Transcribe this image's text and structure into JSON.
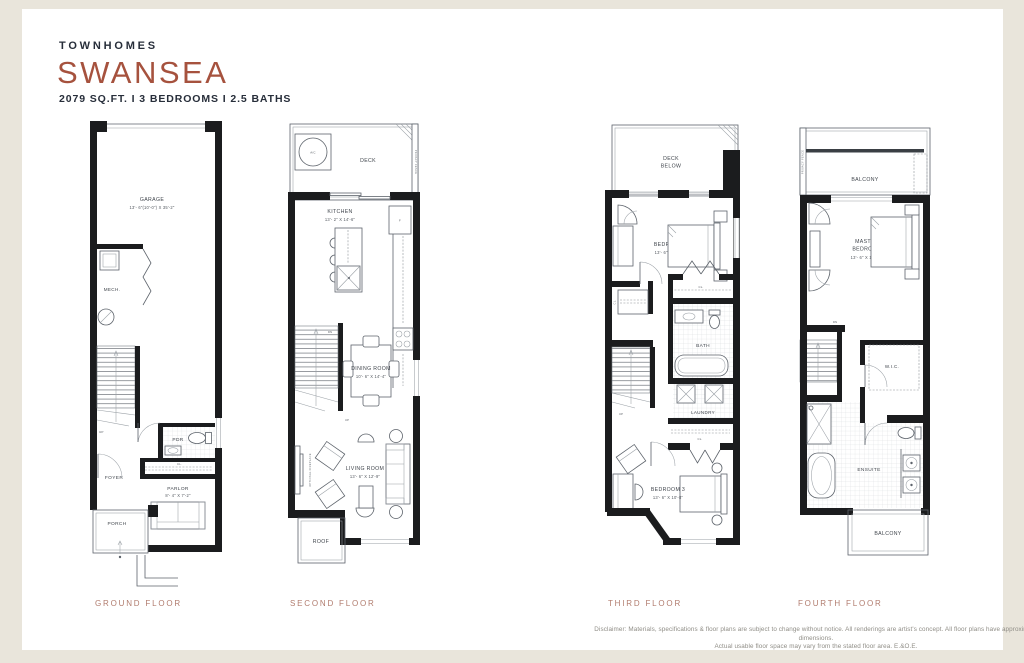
{
  "header": {
    "collection": "TOWNHOMES",
    "model": "SWANSEA",
    "specs": "2079 SQ.FT. I 3 BEDROOMS I 2.5 BATHS"
  },
  "colors": {
    "accent": "#A6523E",
    "caption": "#B17C6E",
    "frame_background": "#E9E5DB",
    "page_background": "#FFFFFF",
    "ink": "#272E3A",
    "wall": "#1B1C1E"
  },
  "plans": {
    "ground": {
      "label": "GROUND FLOOR",
      "garage": "GARAGE",
      "garage_dims": "13'- 6\"(10'-0\") X 35'-2\"",
      "mech": "MECH.",
      "up": "UP",
      "pdr": "PDR",
      "cl": "CL.",
      "foyer": "FOYER",
      "parlor": "PARLOR",
      "parlor_dims": "8'- 4\" X 7'-2\"",
      "porch": "PORCH"
    },
    "second": {
      "label": "SECOND FLOOR",
      "deck": "DECK",
      "ac": "A/C",
      "privacy_fence": "PRIVACY FENCE",
      "kitchen": "KITCHEN",
      "kitchen_dims": "13'- 2\" X 14'-6\"",
      "fridge": "F",
      "dn": "DN",
      "up": "UP",
      "dining": "DINING ROOM",
      "dining_dims": "10'- 6\" X 14'-4\"",
      "living": "LIVING ROOM",
      "living_dims": "13'- 6\" X 12'-9\"",
      "fireplace": "OPTIONAL FIREPLACE",
      "roof": "ROOF"
    },
    "third": {
      "label": "THIRD FLOOR",
      "deck_line1": "DECK",
      "deck_line2": "BELOW",
      "bedroom2": "BEDROOM 2",
      "bedroom2_dims": "13'- 6\" X 10'-10\"",
      "cl_side": "CL.",
      "cl_hall": "CL.",
      "bath": "BATH",
      "laundry": "LAUNDRY",
      "cl_linen": "CL.",
      "up": "UP",
      "bedroom3": "BEDROOM 3",
      "bedroom3_dims": "13'- 6\" X 10'-8\""
    },
    "fourth": {
      "label": "FOURTH FLOOR",
      "balcony": "BALCONY",
      "privacy_fence": "PRIVACY FENCE",
      "master1": "MASTER",
      "master2": "BEDROOM",
      "master_dims": "13'- 6\" X 10'-10\"",
      "dn": "DN",
      "wic": "W.I.C.",
      "ensuite": "ENSUITE",
      "balcony_lower": "BALCONY"
    }
  },
  "disclaimer": {
    "line1": "Disclaimer: Materials, specifications & floor plans are subject to change without notice. All renderings are artist's concept. All floor plans have approximate dimensions.",
    "line2": "Actual usable floor space may vary from the stated floor area. E.&O.E."
  }
}
